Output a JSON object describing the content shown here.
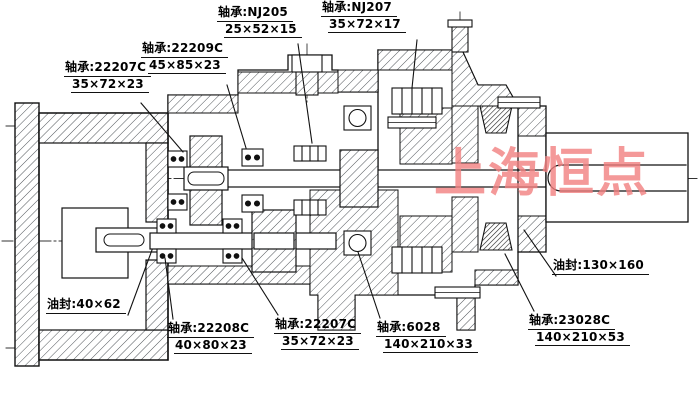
{
  "watermark": "上海恒点",
  "colors": {
    "line": "#111111",
    "hatch": "#50555a",
    "watermark": "#f28080",
    "background": "#ffffff"
  },
  "callouts": [
    {
      "name": "bearing-22207c-top",
      "line1": "轴承:22207C",
      "line2": "35×72×23"
    },
    {
      "name": "bearing-22209c",
      "line1": "轴承:22209C",
      "line2": "45×85×23"
    },
    {
      "name": "bearing-nj205",
      "line1": "轴承:NJ205",
      "line2": "25×52×15"
    },
    {
      "name": "bearing-nj207",
      "line1": "轴承:NJ207",
      "line2": "35×72×17"
    },
    {
      "name": "oil-seal-right",
      "line1": "油封:130×160",
      "line2": ""
    },
    {
      "name": "oil-seal-left",
      "line1": "油封:40×62",
      "line2": ""
    },
    {
      "name": "bearing-22208c",
      "line1": "轴承:22208C",
      "line2": "40×80×23"
    },
    {
      "name": "bearing-22207c-bottom",
      "line1": "轴承:22207C",
      "line2": "35×72×23"
    },
    {
      "name": "bearing-6028",
      "line1": "轴承:6028",
      "line2": "140×210×33"
    },
    {
      "name": "bearing-23028c",
      "line1": "轴承:23028C",
      "line2": "140×210×53"
    }
  ]
}
